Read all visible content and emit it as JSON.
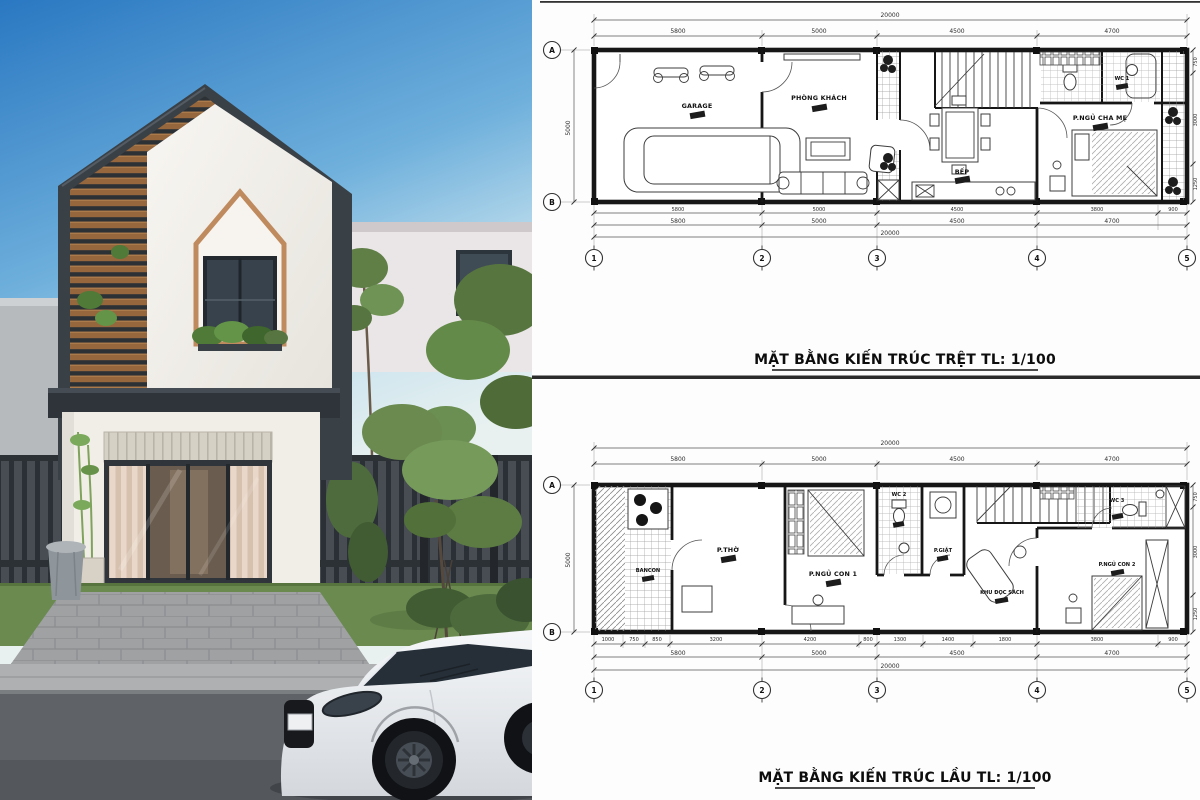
{
  "colors": {
    "sky_top": "#2a78c2",
    "sky_horizon": "#dcebf0",
    "house_frame": "#3a4047",
    "wood_slat": "#96663c",
    "white_wall": "#f4f2ee",
    "fence": "#3f444a",
    "grass": "#6a8a50",
    "road": "#5f6267",
    "car_body": "#f2f4f6",
    "plan_line": "#161616",
    "paper": "#ffffff"
  },
  "plans": {
    "grid_cols": [
      "1",
      "2",
      "3",
      "4",
      "5"
    ],
    "grid_rows": [
      "A",
      "B"
    ],
    "ground": {
      "title": "MẶT BẰNG KIẾN TRÚC TRỆT TL: 1/100",
      "rooms": {
        "garage": "GARAGE",
        "living": "PHÒNG KHÁCH",
        "kitchen": "BẾP",
        "master_bedroom": "P.NGỦ CHA MẸ",
        "wc1": "WC 1"
      },
      "dim_total": "20000",
      "dims_top": [
        "5800",
        "5000",
        "4500",
        "4700"
      ],
      "dims_bottom_row1": [
        "5800",
        "5000",
        "4500",
        "3800",
        "900"
      ],
      "dims_bottom_row2": [
        "5800",
        "5000",
        "4500",
        "4700"
      ],
      "dim_left": "5000",
      "dims_right": [
        "750",
        "3000",
        "1250"
      ]
    },
    "upper": {
      "title": "MẶT BẰNG KIẾN TRÚC LẦU TL: 1/100",
      "rooms": {
        "balcony": "BANCON",
        "worship": "P.THỜ",
        "bedroom1": "P.NGỦ CON 1",
        "wc2": "WC 2",
        "laundry": "P.GIẶT",
        "reading": "KHU ĐỌC SÁCH",
        "wc3": "WC 3",
        "bedroom2": "P.NGỦ CON 2"
      },
      "dim_total": "20000",
      "dims_top": [
        "5800",
        "5000",
        "4500",
        "4700"
      ],
      "dims_bottom_row1": [
        "1000",
        "750",
        "850",
        "3200",
        "4200",
        "800",
        "1300",
        "1400",
        "1800",
        "3800",
        "900"
      ],
      "dims_bottom_row2": [
        "5800",
        "5000",
        "4500",
        "4700"
      ],
      "dim_left": "5000",
      "dims_right": [
        "750",
        "3000",
        "1250"
      ]
    }
  }
}
